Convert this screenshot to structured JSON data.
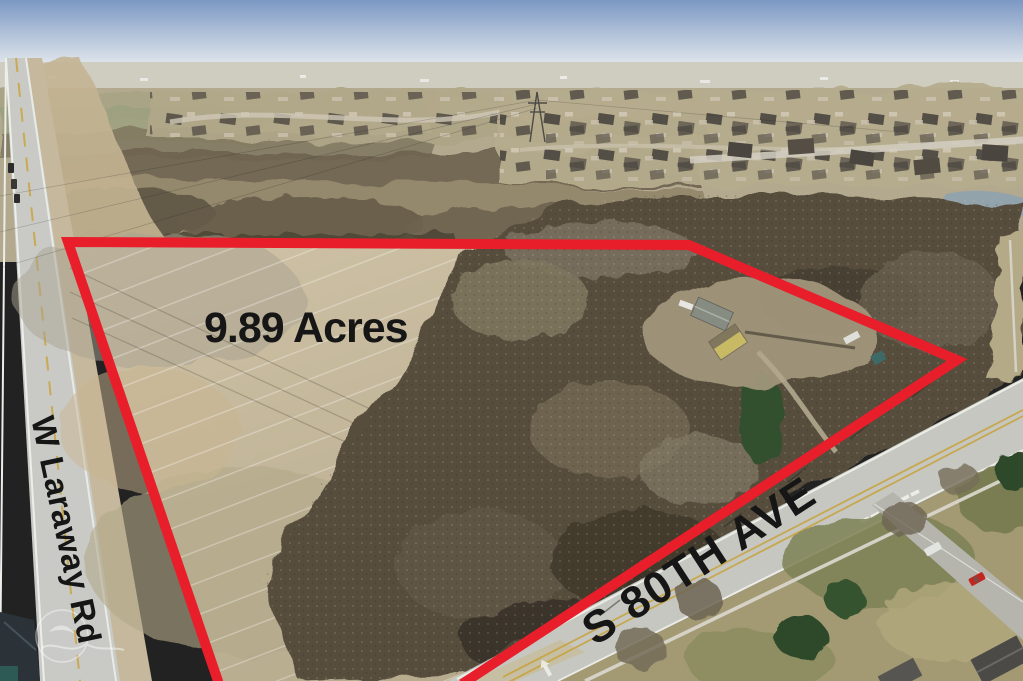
{
  "labels": {
    "acreage": "9.89 Acres",
    "road_west": "W Laraway Rd",
    "road_south": "S 80TH AVE"
  },
  "colors": {
    "boundary": "#e81e2b"
  }
}
